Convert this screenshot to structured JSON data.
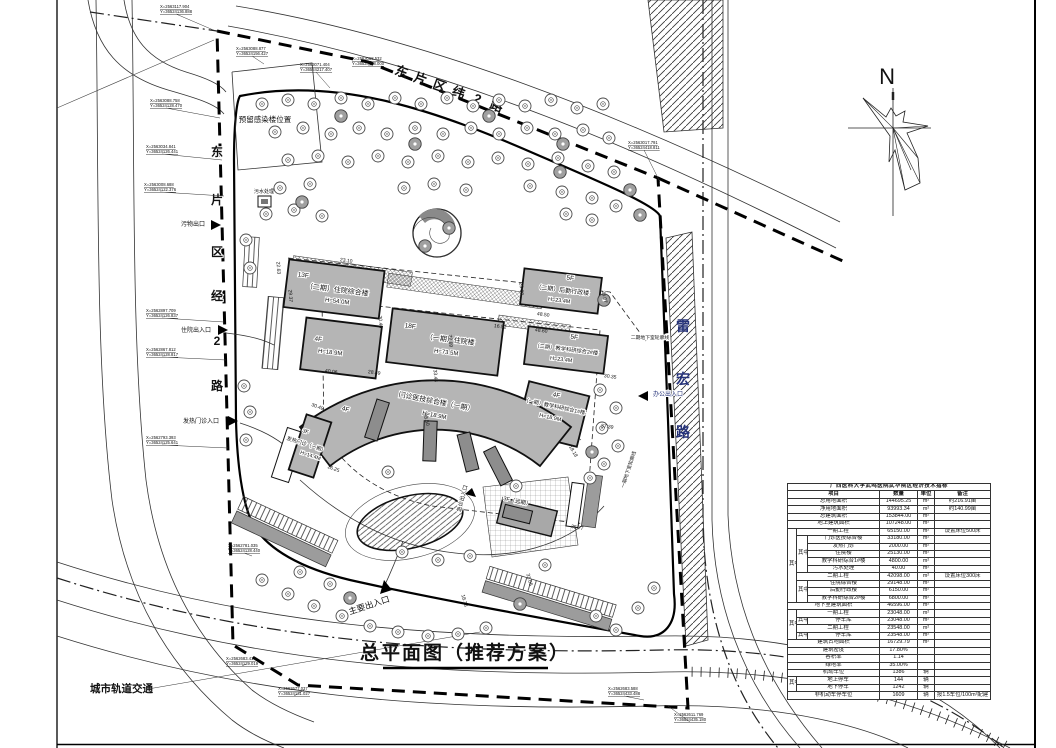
{
  "sheet_title": "总平面图（推荐方案）",
  "north": "N",
  "roads": {
    "top": [
      "东",
      "片",
      "区",
      "纬",
      "2",
      "路"
    ],
    "left": [
      "东",
      "片",
      "区",
      "经",
      "2",
      "路"
    ],
    "right": [
      "雷",
      "宏",
      "路"
    ],
    "rail": "城市轨道交通"
  },
  "entrances": {
    "main": "主要出入口",
    "inpatient": "住院出入口",
    "waste": "污物出口",
    "fever": "发热门诊入口",
    "office": "办公出入口",
    "emergency": "急诊出入口"
  },
  "notes": {
    "reserved": "预留感染楼位置",
    "sewage": "污水处理",
    "u1": "一期地下室轮廓线",
    "u2": "二期地下室轮廓线"
  },
  "buildings": {
    "b1": {
      "l1": "13F",
      "l2": "（二期）住院综合楼",
      "l3": "H=54.0M"
    },
    "b2": {
      "l1": "4F",
      "l2": "H=18.9M"
    },
    "b3": {
      "l1": "18F",
      "l2": "（一期）住院楼",
      "l3": "H=73.5M"
    },
    "b4": {
      "l1": "5F",
      "l2": "（二期）后勤行政楼",
      "l3": "H=23.4M"
    },
    "b5": {
      "l1": "5F",
      "l2": "（二期）教学科研综合2#楼",
      "l3": "H=23.4M"
    },
    "b6": {
      "l1": "4F",
      "l2": "（一期）教学科研综合1#楼",
      "l3": "H=18.9M"
    },
    "b7": {
      "l1": "门诊医技综合楼（一期）",
      "l2": "4F",
      "l3": "H=18.9M"
    },
    "b8": {
      "l1": "3F",
      "l2": "发热门诊（一期）",
      "l3": "H=14.4M"
    },
    "b9": {
      "l1": "3F（远期）"
    }
  },
  "dims": [
    "23.10",
    "22.63",
    "29.37",
    "20.46",
    "28.49",
    "40.06",
    "72.69",
    "33.44",
    "16.52",
    "48.50",
    "48.60",
    "23.00",
    "26.07",
    "30.35",
    "37.39",
    "18.18",
    "38.50",
    "30.49",
    "16.25",
    "35.77",
    "18.78",
    "31.05"
  ],
  "coords": [
    {
      "x": "X=2563117.904",
      "y": "Y=36524136.888"
    },
    {
      "x": "X=2563071.404",
      "y": "Y=36524217.407"
    },
    {
      "x": "X=2563068.532",
      "y": "Y=36524198.000"
    },
    {
      "x": "X=2563088.877",
      "y": "Y=36524156.427"
    },
    {
      "x": "X=2563088.758",
      "y": "Y=36524128.470"
    },
    {
      "x": "X=2563034.841",
      "y": "Y=36524126.441"
    },
    {
      "x": "X=2563008.688",
      "y": "Y=36524122.376"
    },
    {
      "x": "X=2563017.791",
      "y": "Y=36524418.811"
    },
    {
      "x": "X=2562897.709",
      "y": "Y=36524126.837"
    },
    {
      "x": "X=2562867.812",
      "y": "Y=36524128.817"
    },
    {
      "x": "X=2562793.393",
      "y": "Y=36524125.641"
    },
    {
      "x": "X=2562781.035",
      "y": "Y=36524128.440"
    },
    {
      "x": "X=2562683.414",
      "y": "Y=36524129.019"
    },
    {
      "x": "X=2562677.037",
      "y": "Y=36524131.027"
    },
    {
      "x": "X=2562683.588",
      "y": "Y=36524433.488"
    },
    {
      "x": "X=2562611.769",
      "y": "Y=36524435.180"
    }
  ],
  "table": {
    "title": "广西医科大学武鸣医院武华院区经济技术指标",
    "headers": [
      "项目",
      "数量",
      "单位",
      "备注"
    ],
    "zhong": "其中",
    "rows": [
      {
        "label": "总用地面积",
        "qty": "144695.25",
        "unit": "m²",
        "note": "约216.91亩"
      },
      {
        "label": "净用地面积",
        "qty": "93993.34",
        "unit": "m²",
        "note": "约140.99亩"
      },
      {
        "label": "总建筑面积",
        "qty": "153844.00",
        "unit": "m²"
      },
      {
        "label": "地上建筑面积",
        "qty": "107248.00",
        "unit": "m²"
      },
      {
        "label": "一期工程",
        "qty": "65150.00",
        "unit": "m²",
        "note": "设置床位500床"
      },
      {
        "label": "门诊医技综合楼",
        "qty": "33180.00",
        "unit": "m²"
      },
      {
        "label": "发热门诊",
        "qty": "2000.00",
        "unit": "m²"
      },
      {
        "label": "住院楼",
        "qty": "25130.00",
        "unit": "m²"
      },
      {
        "label": "教学科研综合1#楼",
        "qty": "4800.00",
        "unit": "m²"
      },
      {
        "label": "污水处理",
        "qty": "40.00",
        "unit": "m²"
      },
      {
        "label": "二期工程",
        "qty": "42098.00",
        "unit": "m²",
        "note": "设置床位300床"
      },
      {
        "label": "住院综合楼",
        "qty": "29148.00",
        "unit": "m²"
      },
      {
        "label": "后勤行政楼",
        "qty": "6150.00",
        "unit": "m²"
      },
      {
        "label": "教学科研综合2#楼",
        "qty": "6800.00",
        "unit": "m²"
      },
      {
        "label": "地下室建筑面积",
        "qty": "46596.00",
        "unit": "m²"
      },
      {
        "label": "一期工程",
        "qty": "23048.00",
        "unit": "m²"
      },
      {
        "label": "停车库",
        "qty": "23048.00",
        "unit": "m²"
      },
      {
        "label": "二期工程",
        "qty": "23548.00",
        "unit": "m²"
      },
      {
        "label": "停车库",
        "qty": "23548.00",
        "unit": "m²"
      },
      {
        "label": "建筑占地面积",
        "qty": "16729.79",
        "unit": "m²"
      },
      {
        "label": "建筑密度",
        "qty": "17.80%"
      },
      {
        "label": "容积率",
        "qty": "1.14"
      },
      {
        "label": "绿地率",
        "qty": "35.00%"
      },
      {
        "label": "机动车位",
        "qty": "1386",
        "unit": "辆"
      },
      {
        "label": "地上停车",
        "qty": "144",
        "unit": "辆"
      },
      {
        "label": "地下停车",
        "qty": "1242",
        "unit": "辆"
      },
      {
        "label": "非机动车停车位",
        "qty": "1609",
        "unit": "辆",
        "note": "按1.5车位/100m²配建"
      }
    ]
  }
}
